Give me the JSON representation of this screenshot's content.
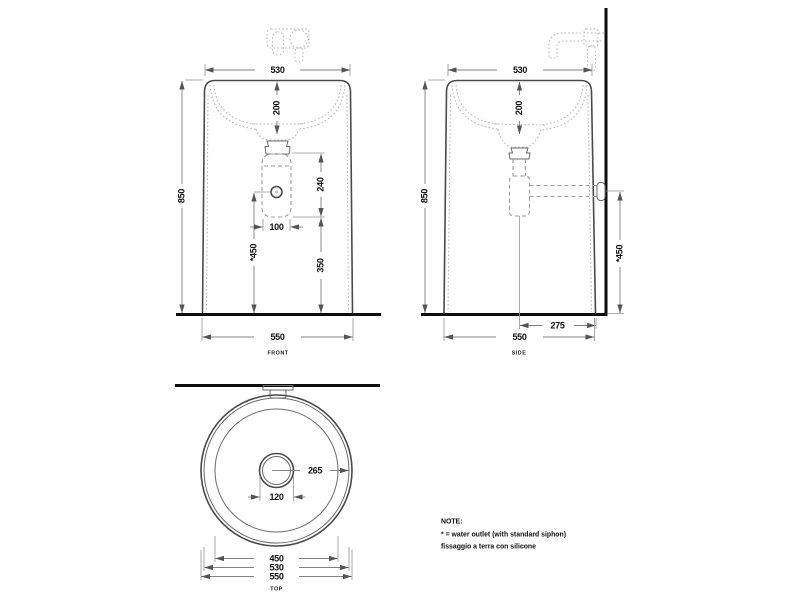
{
  "page": {
    "background": "#ffffff"
  },
  "front_view": {
    "label": "FRONT",
    "dim_width_top": "530",
    "dim_basin_depth": "200",
    "dim_height": "850",
    "dim_siphon_length": "240",
    "dim_siphon_width": "100",
    "dim_siphon_to_floor": "350",
    "dim_outlet_height": "*450",
    "dim_width_bottom": "550"
  },
  "side_view": {
    "label": "SIDE",
    "dim_width_top": "530",
    "dim_basin_depth": "200",
    "dim_height": "850",
    "dim_outlet_height": "*450",
    "dim_drain_to_wall": "275",
    "dim_depth_bottom": "550"
  },
  "top_view": {
    "label": "TOP",
    "dim_center_to_rim": "265",
    "dim_drain_hole": "120",
    "dim_bowl_diameter": "450",
    "dim_rim_diameter": "530",
    "dim_outer_diameter": "550"
  },
  "note": {
    "title": "NOTE:",
    "lines": [
      "* = water outlet (with standard siphon)",
      "fissaggio a terra con silicone"
    ]
  },
  "colors": {
    "outline": "#4a4a4a",
    "dimension": "#828282",
    "structure": "#0d0d0d",
    "text": "#111111"
  }
}
